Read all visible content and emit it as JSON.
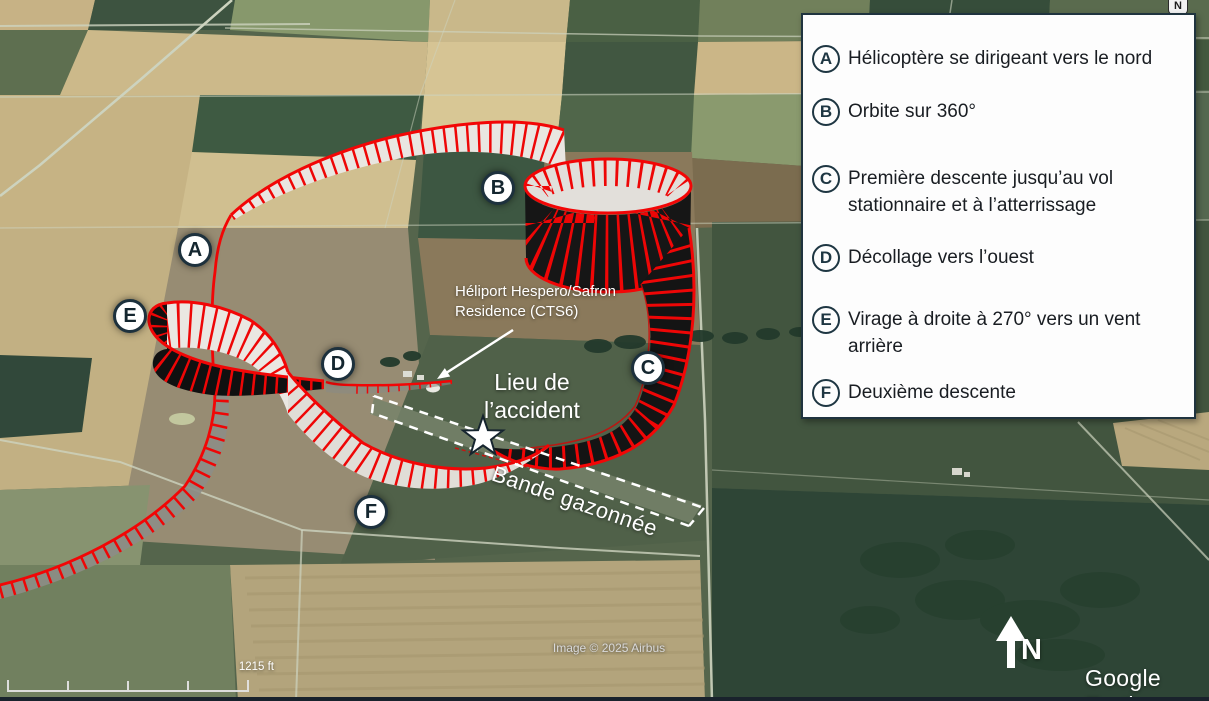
{
  "legend": {
    "items": [
      {
        "letter": "A",
        "label": "Hélicoptère se dirigeant vers le nord"
      },
      {
        "letter": "B",
        "label": "Orbite sur 360°"
      },
      {
        "letter": "C",
        "label": "Première descente jusqu’au vol stationnaire et à l’atterrissage"
      },
      {
        "letter": "D",
        "label": "Décollage vers l’ouest"
      },
      {
        "letter": "E",
        "label": "Virage à droite à 270° vers un vent arrière"
      },
      {
        "letter": "F",
        "label": "Deuxième descente"
      }
    ]
  },
  "map": {
    "markers": [
      {
        "letter": "A"
      },
      {
        "letter": "B"
      },
      {
        "letter": "C"
      },
      {
        "letter": "D"
      },
      {
        "letter": "E"
      },
      {
        "letter": "F"
      }
    ],
    "labels": {
      "heliport": "Héliport Hespero/Safron Residence (CTS6)",
      "accident_site": "Lieu de l’accident",
      "grass_strip": "Bande gazonnée"
    },
    "scale_label": "1215 ft",
    "north_label": "N",
    "compass_label": "N",
    "credits": {
      "imagery": "Image © 2025 Airbus",
      "watermark": "Google Earth"
    },
    "path_color": "#ee0606",
    "marker_ring_color": "#1d313d"
  }
}
